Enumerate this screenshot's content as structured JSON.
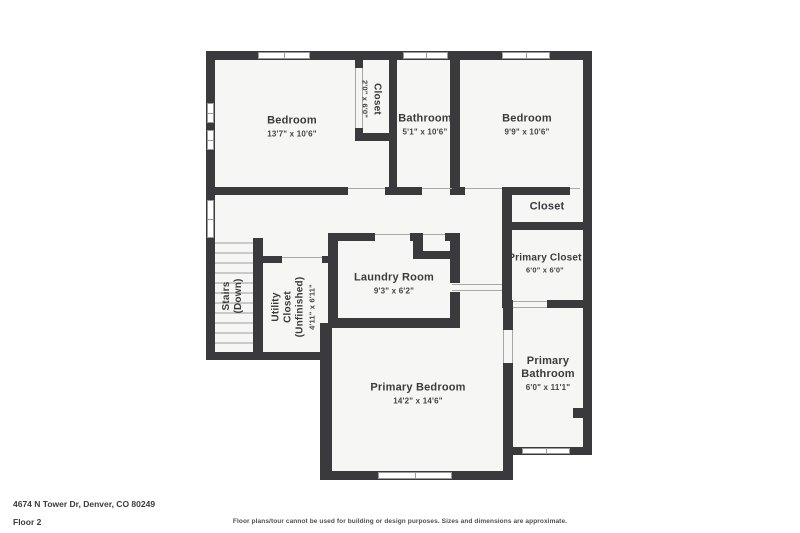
{
  "floorplan": {
    "rooms": {
      "bedroom1": {
        "name": "Bedroom",
        "dims": "13'7\" x 10'6\""
      },
      "closet1": {
        "name": "Closet",
        "dims": "2'0\" x 6'0\""
      },
      "bathroom": {
        "name": "Bathroom",
        "dims": "5'1\" x 10'6\""
      },
      "bedroom2": {
        "name": "Bedroom",
        "dims": "9'9\" x 10'6\""
      },
      "closet2": {
        "name": "Closet"
      },
      "primary_closet": {
        "name": "Primary Closet",
        "dims": "6'0\" x 6'0\""
      },
      "laundry": {
        "name": "Laundry Room",
        "dims": "9'3\" x 6'2\""
      },
      "utility": {
        "line1": "Utility",
        "line2": "Closet",
        "line3": "(Unfinished)",
        "dims": "4'11\" x 6'11\""
      },
      "stairs": {
        "line1": "Stairs",
        "line2": "(Down)"
      },
      "primary_bedroom": {
        "name": "Primary Bedroom",
        "dims": "14'2\" x 14'6\""
      },
      "primary_bathroom": {
        "line1": "Primary",
        "line2": "Bathroom",
        "dims": "6'0\" x 11'1\""
      }
    },
    "footer": {
      "address": "4674 N Tower Dr, Denver, CO 80249",
      "floor_label": "Floor 2",
      "disclaimer": "Floor plans/tour cannot be used for building or design purposes. Sizes and dimensions are approximate."
    },
    "colors": {
      "wall": "#3a3a3c",
      "floor": "#f6f6f4",
      "background": "#ffffff"
    }
  }
}
